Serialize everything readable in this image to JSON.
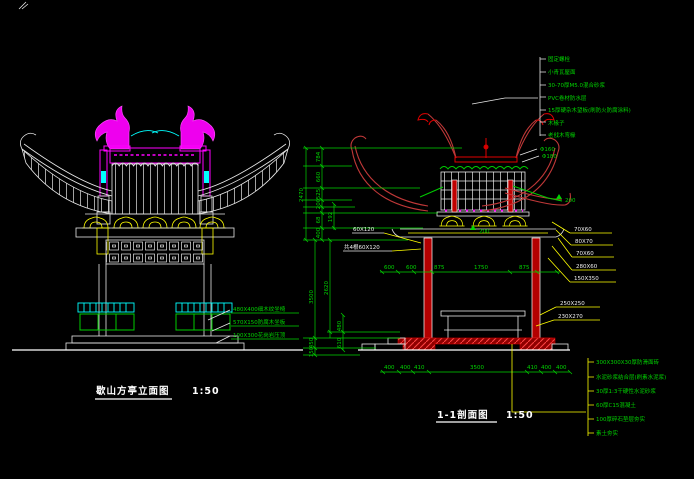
{
  "app": {
    "background": "#000000"
  },
  "colors": {
    "structure_white": "#f0f0f0",
    "annotation_green": "#00d400",
    "leader_yellow": "#ffff00",
    "decor_magenta": "#ff00ff",
    "rail_cyan": "#00ffff",
    "roof_red": "#c03838",
    "column_red": "#b40000"
  },
  "left": {
    "title": "歇山方亭立面图",
    "scale": "1:50",
    "bench_labels": [
      "480X400细木纹坐椅",
      "570X150防腐木坐板",
      "100X300花岗岩压顶"
    ]
  },
  "right": {
    "title": "1-1剖面图",
    "scale": "1:50",
    "roof_layers": [
      "固定螺栓",
      "小青瓦屋面",
      "30-70厚M5.0混合砂浆",
      "PVC卷材防水层",
      "15厚硬杂木望板(刷防火防腐涂料)",
      "木椽子",
      "老戗木弯椽"
    ],
    "floor_layers": [
      "300X300X30厚防滑面砖",
      "水泥砂浆结合层(刷素水泥浆)",
      "30厚1:3干硬性水泥砂浆",
      "60厚C15混凝土",
      "100厚碎石垫层夯实",
      "素土夯实"
    ],
    "member_labels": [
      "70X60",
      "80X70",
      "70X60",
      "280X60",
      "150X350",
      "250X250",
      "230X270"
    ],
    "beam_labels": [
      "60X120",
      "共4根60X120"
    ],
    "purlin_labels": [
      "Φ160",
      "Φ180"
    ],
    "arrow_labels": [
      "200",
      "200"
    ],
    "dims": {
      "vertical_top": [
        "784",
        "660",
        "525",
        "200",
        "68",
        "400"
      ],
      "vertical_top_overall": "2470",
      "vertical_inner": "192",
      "vertical_mid": [
        "3500",
        "2620"
      ],
      "vertical_low": [
        "480",
        "610",
        "450",
        "150"
      ],
      "horizontal_mid": [
        "600",
        "600",
        "875",
        "1750",
        "875"
      ],
      "horizontal_bottom": [
        "400",
        "400",
        "410",
        "3500",
        "410",
        "400",
        "400"
      ]
    }
  }
}
